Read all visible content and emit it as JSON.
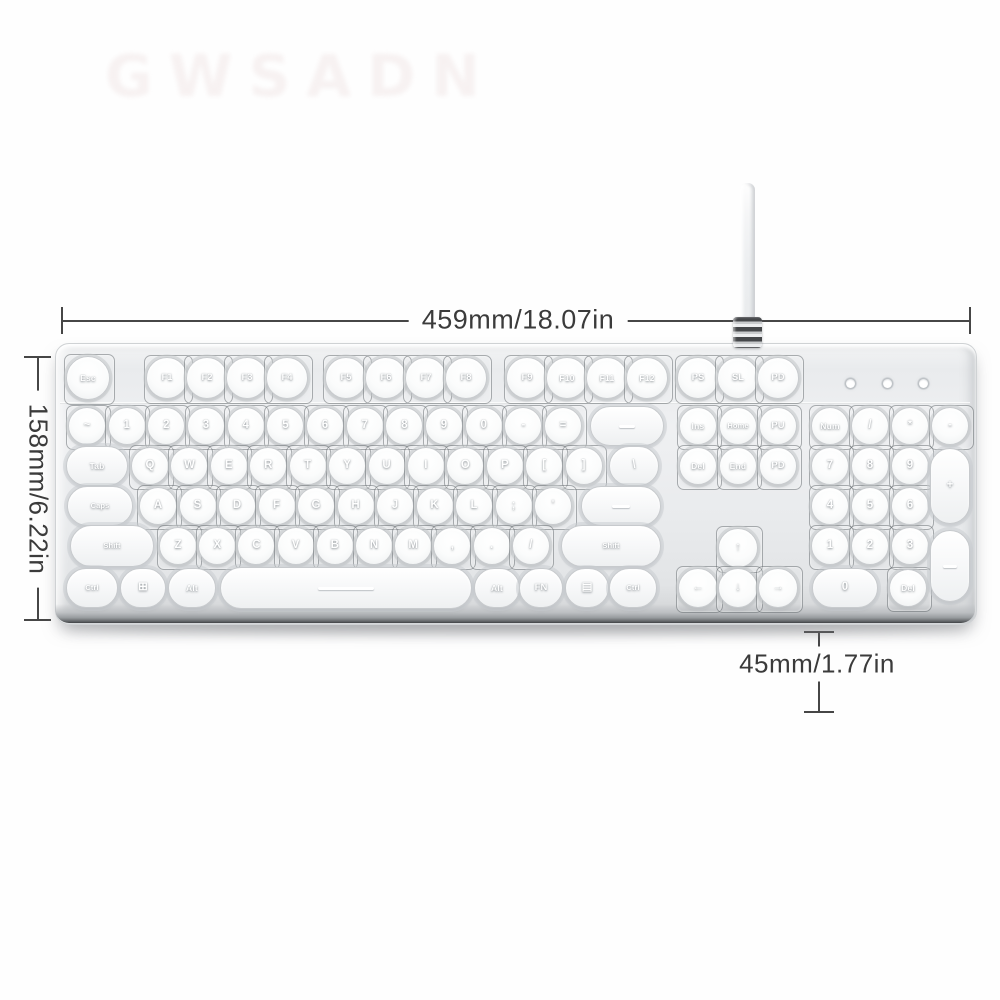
{
  "watermark": {
    "text": "GWSADN"
  },
  "dimensions": {
    "width_label": "459mm/18.07in",
    "height_label": "158mm/6.22in",
    "depth_label": "45mm/1.77in"
  },
  "colors": {
    "body_silver": "#e9ebed",
    "keycap_white": "#ffffff",
    "dimension_line": "#464646"
  },
  "keyboard": {
    "led_count": 3,
    "keys": {
      "function_row": [
        "Esc",
        "F1",
        "F2",
        "F3",
        "F4",
        "F5",
        "F6",
        "F7",
        "F8",
        "F9",
        "F10",
        "F11",
        "F12",
        "PS",
        "SL",
        "PD"
      ],
      "number_row": [
        "~",
        "1",
        "2",
        "3",
        "4",
        "5",
        "6",
        "7",
        "8",
        "9",
        "0",
        "-",
        "="
      ],
      "backspace": "—",
      "nav_top": [
        "Ins",
        "Home",
        "PU"
      ],
      "nav_mid": [
        "Del",
        "End",
        "PD"
      ],
      "tab_row": [
        "Tab",
        "Q",
        "W",
        "E",
        "R",
        "T",
        "Y",
        "U",
        "I",
        "O",
        "P",
        "[",
        "]"
      ],
      "backslash": "\\",
      "caps_row": [
        "Caps",
        "A",
        "S",
        "D",
        "F",
        "G",
        "H",
        "J",
        "K",
        "L",
        ";",
        "'"
      ],
      "enter": "—",
      "shift_row": [
        "Shift",
        "Z",
        "X",
        "C",
        "V",
        "B",
        "N",
        "M",
        ",",
        ".",
        "/"
      ],
      "shift_right": "Shift",
      "arrow_up": "↑",
      "arrows": [
        "←",
        "↓",
        "→"
      ],
      "bottom_row": [
        "Ctrl",
        "⊞",
        "Alt",
        "—",
        "Alt",
        "FN",
        "▤",
        "Ctrl"
      ],
      "numpad_top": [
        "Num",
        "/",
        "*",
        "-"
      ],
      "numpad_789": [
        "7",
        "8",
        "9"
      ],
      "numpad_plus": "+",
      "numpad_456": [
        "4",
        "5",
        "6"
      ],
      "numpad_123": [
        "1",
        "2",
        "3"
      ],
      "numpad_enter": "—",
      "numpad_0": "0",
      "numpad_del": "Del"
    }
  }
}
